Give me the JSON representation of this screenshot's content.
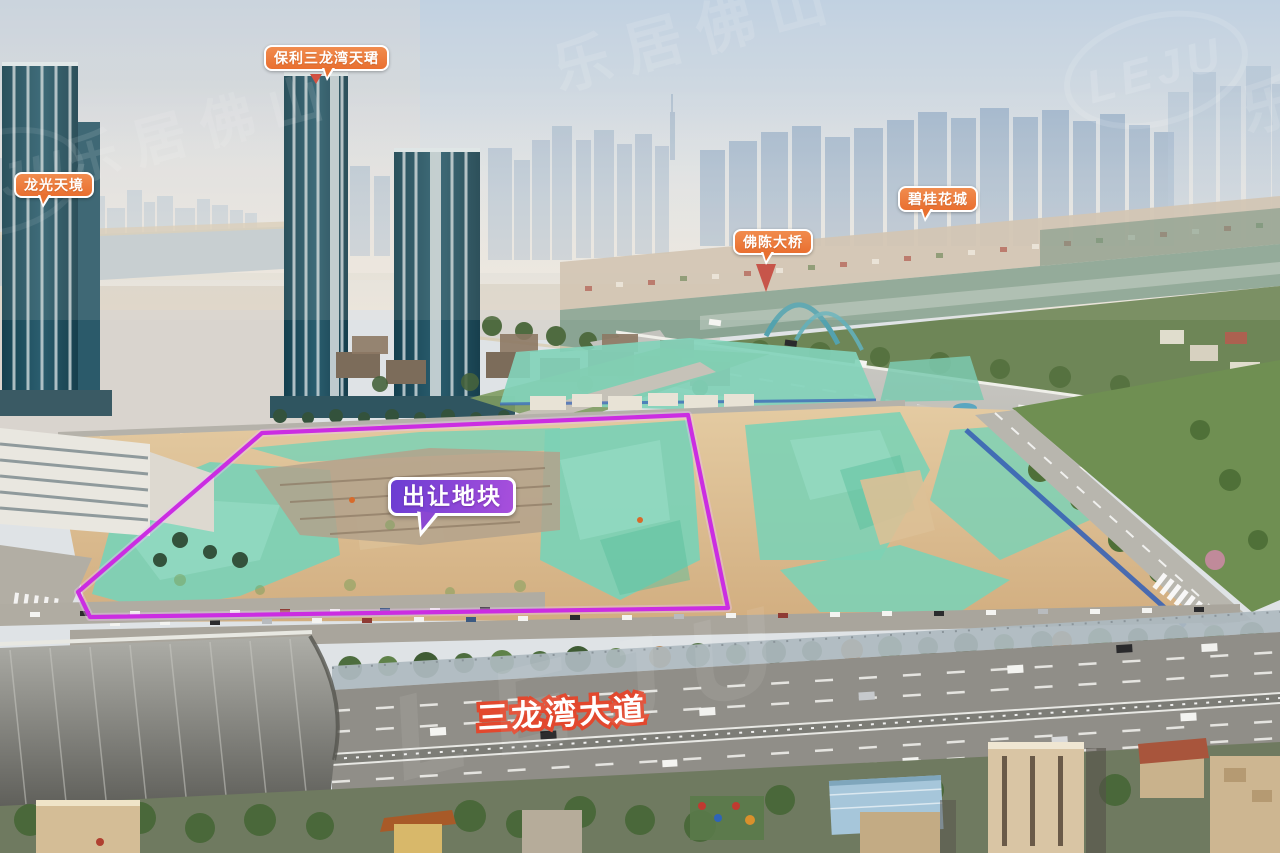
{
  "watermark": {
    "text": "乐居佛山",
    "logo": "LEJU"
  },
  "callouts": {
    "poli": {
      "label": "保利三龙湾天珺"
    },
    "longguang": {
      "label": "龙光天境"
    },
    "biguihuacheng": {
      "label": "碧桂花城"
    },
    "fochen": {
      "label": "佛陈大桥"
    },
    "parcel": {
      "label": "出让地块"
    }
  },
  "road_label": "三龙湾大道",
  "colors": {
    "callout_orange": "#e8702f",
    "callout_purple_start": "#6b3dd2",
    "callout_purple_end": "#a84fdc",
    "parcel_outline": "#cb2de2",
    "road_label_stroke": "#e2482e",
    "netting_teal": "#7dd1b5",
    "earth_tan": "#dcc096"
  }
}
